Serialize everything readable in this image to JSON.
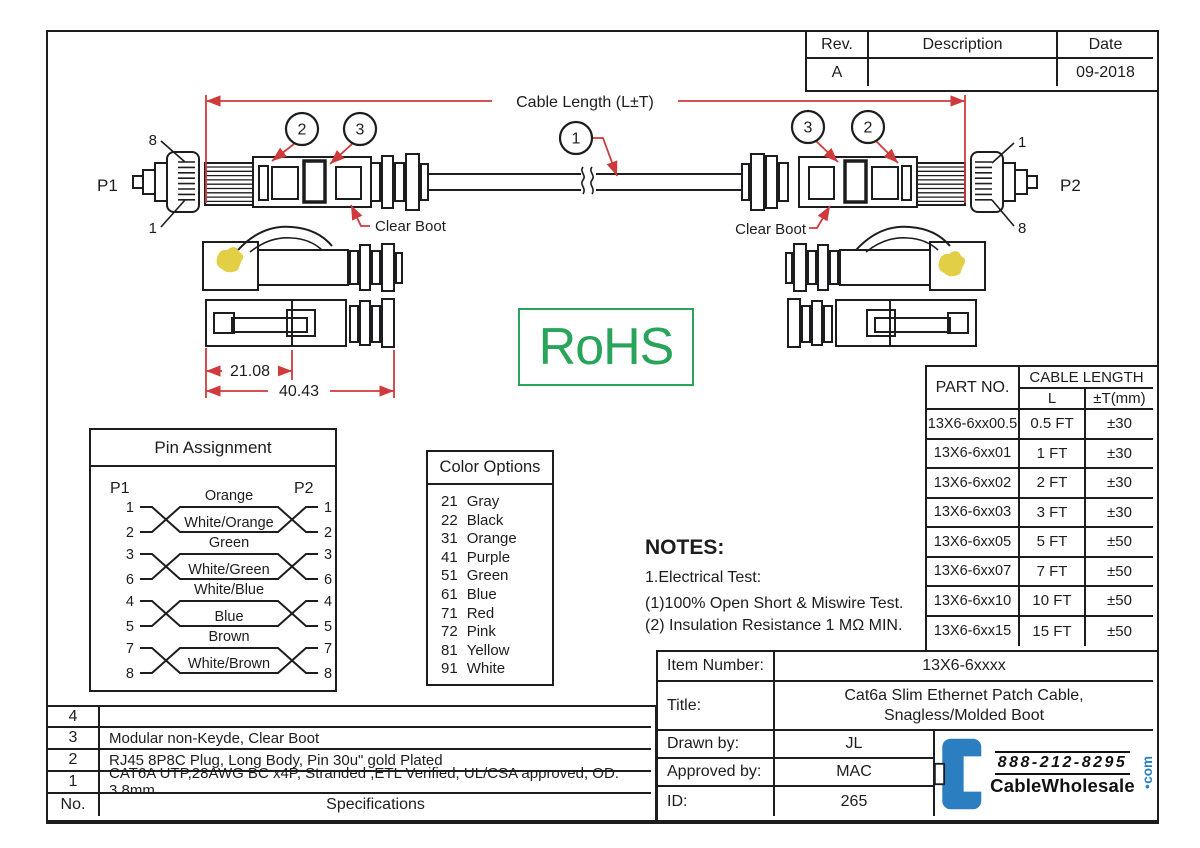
{
  "colors": {
    "line": "#1d1d1f",
    "red": "#cf3a3c",
    "green": "#2aa35b",
    "blue": "#2b7fc0",
    "yellow": "#e3cf45"
  },
  "rev_table": {
    "col_rev": "Rev.",
    "col_description": "Description",
    "col_date": "Date",
    "rev": "A",
    "description": "",
    "date": "09-2018"
  },
  "drawing": {
    "cable_length": "Cable Length (L±T)",
    "p1": "P1",
    "p2": "P2",
    "clear_boot": "Clear Boot",
    "pin8": "8",
    "pin1": "1",
    "callout1": "1",
    "callout2": "2",
    "callout3": "3",
    "dim_body": "21.08",
    "dim_total": "40.43",
    "rohs": "RoHS"
  },
  "pin_assignment": {
    "title": "Pin Assignment",
    "p1": "P1",
    "p2": "P2",
    "pairs": [
      {
        "left_pins": [
          "1",
          "2"
        ],
        "right_pins": [
          "1",
          "2"
        ],
        "top": "Orange",
        "bottom": "White/Orange"
      },
      {
        "left_pins": [
          "3",
          "6"
        ],
        "right_pins": [
          "3",
          "6"
        ],
        "top": "Green",
        "bottom": "White/Green"
      },
      {
        "left_pins": [
          "4",
          "5"
        ],
        "right_pins": [
          "4",
          "5"
        ],
        "top": "White/Blue",
        "bottom": "Blue"
      },
      {
        "left_pins": [
          "7",
          "8"
        ],
        "right_pins": [
          "7",
          "8"
        ],
        "top": "Brown",
        "bottom": "White/Brown"
      }
    ]
  },
  "color_options": {
    "title": "Color Options",
    "items": [
      {
        "code": "21",
        "name": "Gray"
      },
      {
        "code": "22",
        "name": "Black"
      },
      {
        "code": "31",
        "name": "Orange"
      },
      {
        "code": "41",
        "name": "Purple"
      },
      {
        "code": "51",
        "name": "Green"
      },
      {
        "code": "61",
        "name": "Blue"
      },
      {
        "code": "71",
        "name": "Red"
      },
      {
        "code": "72",
        "name": "Pink"
      },
      {
        "code": "81",
        "name": "Yellow"
      },
      {
        "code": "91",
        "name": "White"
      }
    ]
  },
  "notes": {
    "title": "NOTES:",
    "line1": "1.Electrical Test:",
    "line2": "(1)100% Open Short & Miswire Test.",
    "line3": "(2) Insulation Resistance 1 MΩ  MIN."
  },
  "part_table": {
    "part_no_header": "PART NO.",
    "cable_length_header": "CABLE LENGTH",
    "l_header": "L",
    "t_header": "±T(mm)",
    "rows": [
      {
        "part": "13X6-6xx00.5",
        "l": "0.5 FT",
        "t": "±30"
      },
      {
        "part": "13X6-6xx01",
        "l": "1 FT",
        "t": "±30"
      },
      {
        "part": "13X6-6xx02",
        "l": "2 FT",
        "t": "±30"
      },
      {
        "part": "13X6-6xx03",
        "l": "3 FT",
        "t": "±30"
      },
      {
        "part": "13X6-6xx05",
        "l": "5 FT",
        "t": "±50"
      },
      {
        "part": "13X6-6xx07",
        "l": "7 FT",
        "t": "±50"
      },
      {
        "part": "13X6-6xx10",
        "l": "10 FT",
        "t": "±50"
      },
      {
        "part": "13X6-6xx15",
        "l": "15 FT",
        "t": "±50"
      }
    ]
  },
  "title_block": {
    "item_number_label": "Item Number:",
    "item_number": "13X6-6xxxx",
    "title_label": "Title:",
    "title_line1": "Cat6a Slim Ethernet Patch Cable,",
    "title_line2": "Snagless/Molded Boot",
    "drawn_by_label": "Drawn by:",
    "drawn_by": "JL",
    "approved_by_label": "Approved by:",
    "approved_by": "MAC",
    "id_label": "ID:",
    "id": "265"
  },
  "logo": {
    "phone": "888-212-8295",
    "name": "CableWholesale",
    "tld": "com",
    "dot": "•"
  },
  "spec_table": {
    "rows": [
      {
        "no": "4",
        "spec": ""
      },
      {
        "no": "3",
        "spec": "Modular non-Keyde, Clear Boot"
      },
      {
        "no": "2",
        "spec": "RJ45 8P8C  Plug, Long Body, Pin 30u\" gold Plated"
      },
      {
        "no": "1",
        "spec": "CAT6A UTP,28AWG BC x4P, Stranded ,ETL Verified, UL/CSA approved, OD: 3.8mm"
      }
    ],
    "footer_no": "No.",
    "footer_spec": "Specifications"
  }
}
